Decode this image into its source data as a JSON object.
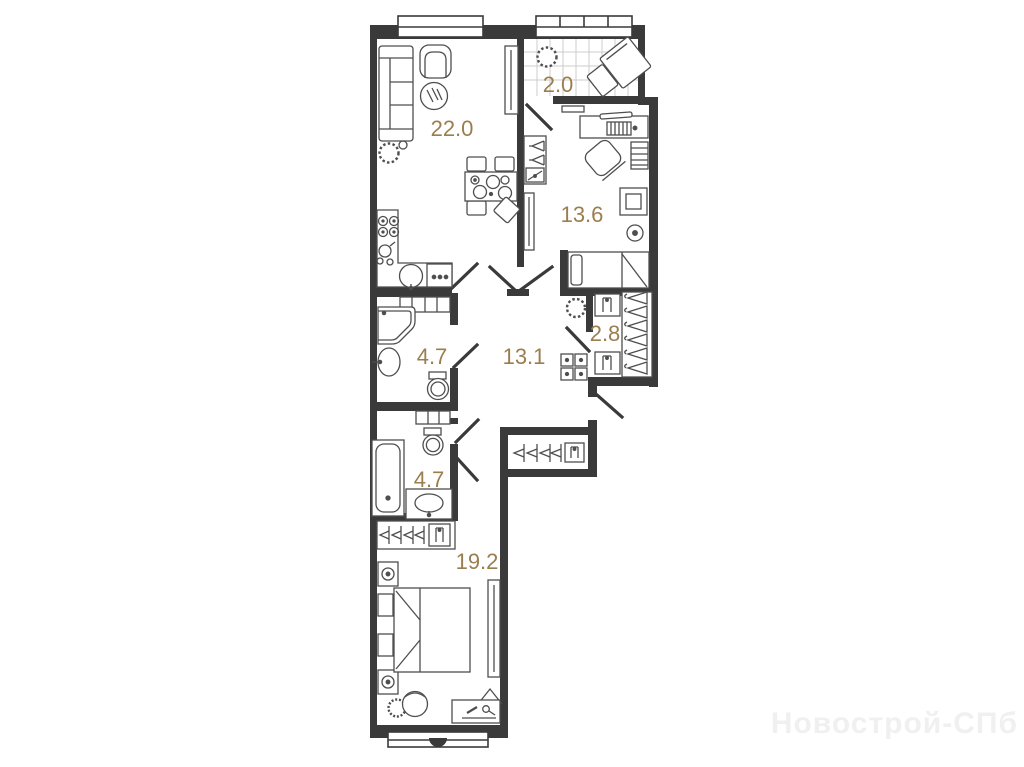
{
  "plan": {
    "rooms": [
      {
        "name": "living-kitchen",
        "area": "22.0"
      },
      {
        "name": "balcony",
        "area": "2.0"
      },
      {
        "name": "bedroom-1",
        "area": "13.6"
      },
      {
        "name": "bathroom-1",
        "area": "4.7"
      },
      {
        "name": "hallway",
        "area": "13.1"
      },
      {
        "name": "wardrobe",
        "area": "2.8"
      },
      {
        "name": "bathroom-2",
        "area": "4.7"
      },
      {
        "name": "bedroom-2",
        "area": "19.2"
      }
    ],
    "colors": {
      "wall": "#3a3a3a",
      "furniture_line": "#4e4e4e",
      "area_label": "#9b7e4e",
      "tile_line": "#cccccc",
      "watermark": "#f0f0f0"
    }
  },
  "watermark": {
    "text": "Новострой-СПб"
  }
}
